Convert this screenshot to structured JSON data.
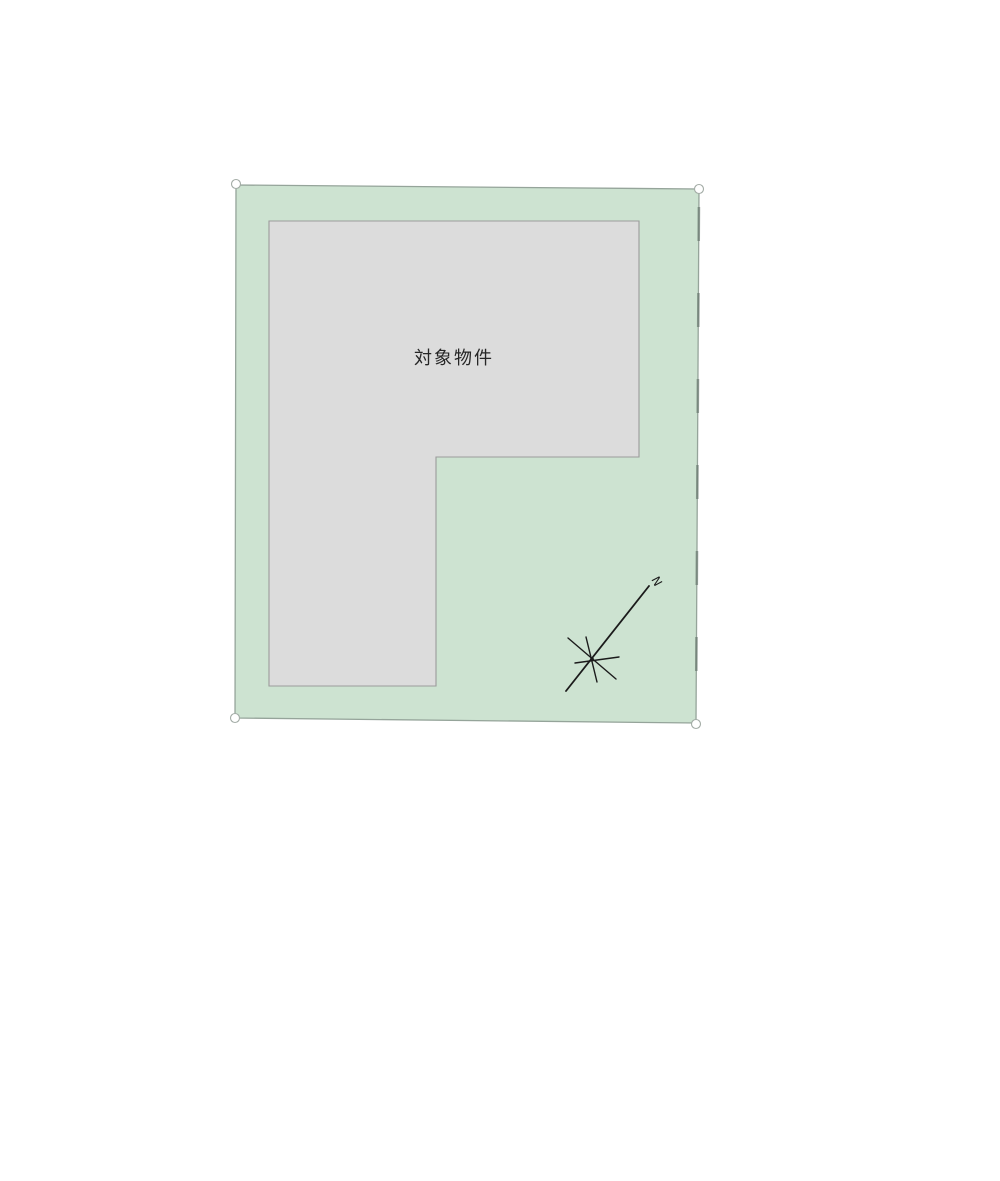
{
  "page": {
    "background": "#ffffff"
  },
  "plan": {
    "parcel": {
      "name": "land parcel",
      "points": "236,185 699,189 696,723 235,718",
      "fill": "#cde3d1",
      "stroke": "#95a49a",
      "edge_ticks_points": "699,189 696,723",
      "edge_ticks_color": "#66756b"
    },
    "building": {
      "label": "対象物件",
      "points": "269,221 639,221 639,457 436,457 436,686 269,686",
      "fill": "#dcdcdc",
      "stroke": "#9b9b9b",
      "label_x": 454,
      "label_y": 364,
      "label_color": "#262626",
      "label_size": 18
    },
    "corner_handles": [
      {
        "cx": 236,
        "cy": 184
      },
      {
        "cx": 699,
        "cy": 189
      },
      {
        "cx": 696,
        "cy": 724
      },
      {
        "cx": 235,
        "cy": 718
      }
    ],
    "compass": {
      "label": "N",
      "label_x": 653,
      "label_y": 584,
      "label_transform": "rotate(62 656 580)",
      "color": "#1b1b1b",
      "hub_cx": 592,
      "hub_cy": 659,
      "needle_points": "566,691 649,586",
      "rays": [
        {
          "points": "568,638 616,679"
        },
        {
          "points": "586,637 597,682"
        },
        {
          "points": "575,663 619,657"
        }
      ]
    }
  }
}
